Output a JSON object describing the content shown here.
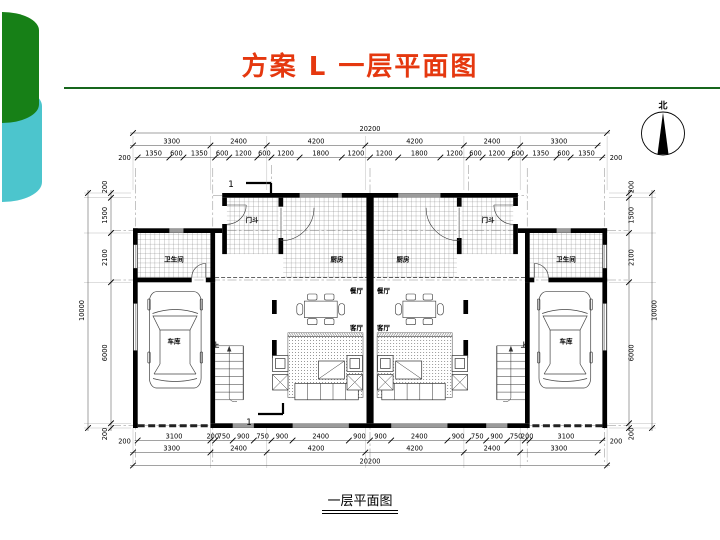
{
  "slide": {
    "title": "方案 L  一层平面图",
    "caption": "一层平面图",
    "colors": {
      "title_red": "#e5380f",
      "rule_green": "#17661c",
      "shape_green": "#178017",
      "shape_teal": "#4cc5cd"
    }
  },
  "compass": {
    "label": "北"
  },
  "plan": {
    "section_marker": "1",
    "rooms": {
      "bathroom": "卫生间",
      "kitchen": "厨房",
      "vestibule": "门斗",
      "dining": "餐厅",
      "living": "客厅",
      "garage": "车库",
      "up": "上"
    },
    "dimensions": {
      "top": {
        "row1": [
          "20200"
        ],
        "row2": [
          "3300",
          "2400",
          "4200",
          "4200",
          "2400",
          "3300"
        ],
        "row3": [
          "1350",
          "600",
          "1350",
          "600",
          "1200",
          "600",
          "1200",
          "1800",
          "1200",
          "1200",
          "1800",
          "1200",
          "600",
          "1200",
          "600",
          "1350",
          "600",
          "1350"
        ],
        "end_labels": [
          "200",
          "200"
        ]
      },
      "bottom": {
        "row1": [
          "3100",
          "200",
          "750",
          "900",
          "750",
          "900",
          "2400",
          "900",
          "900",
          "2400",
          "900",
          "750",
          "900",
          "750",
          "200",
          "3100"
        ],
        "row2": [
          "3300",
          "2400",
          "4200",
          "4200",
          "2400",
          "3300"
        ],
        "row3": [
          "20200"
        ],
        "end_labels": [
          "200",
          "200"
        ]
      },
      "left": {
        "inner": [
          "200",
          "1500",
          "2100",
          "6000",
          "200"
        ],
        "outer": [
          "10000"
        ]
      },
      "right": {
        "inner": [
          "200",
          "1500",
          "2100",
          "6000",
          "200"
        ],
        "outer": [
          "10000"
        ]
      }
    }
  }
}
